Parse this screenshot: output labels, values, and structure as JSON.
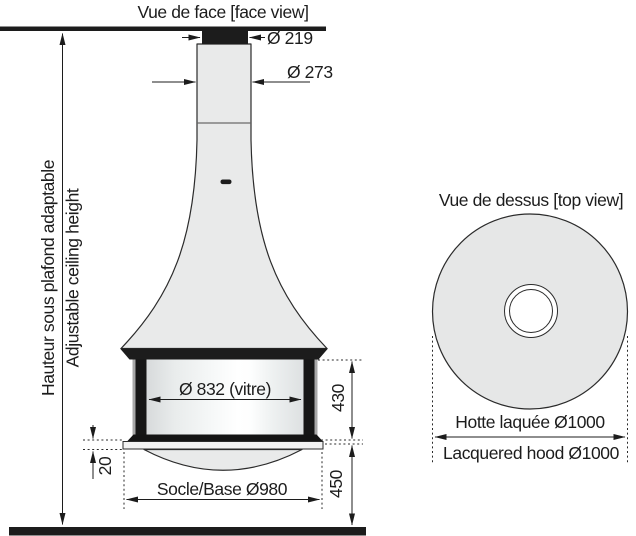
{
  "colors": {
    "ink": "#1c1c1c",
    "body": "#e9eaea",
    "hood_top": "#e6e7e7",
    "outline": "#2b2b2b"
  },
  "face_view": {
    "title": "Vue de face [face view]",
    "ceiling_height_label_fr": "Hauteur sous plafond adaptable",
    "ceiling_height_label_en": "Adjustable ceiling height",
    "flue_collar_diameter": "Ø 219",
    "flue_pipe_diameter": "Ø 273",
    "glass_diameter": "Ø 832 (vitre)",
    "glass_height": "430",
    "base_plate_thickness": "20",
    "base_diameter": "Socle/Base Ø980",
    "base_to_floor_height": "450"
  },
  "top_view": {
    "title": "Vue de dessus [top view]",
    "hood_diameter_fr": "Hotte laquée Ø1000",
    "hood_diameter_en": "Lacquered hood Ø1000"
  }
}
